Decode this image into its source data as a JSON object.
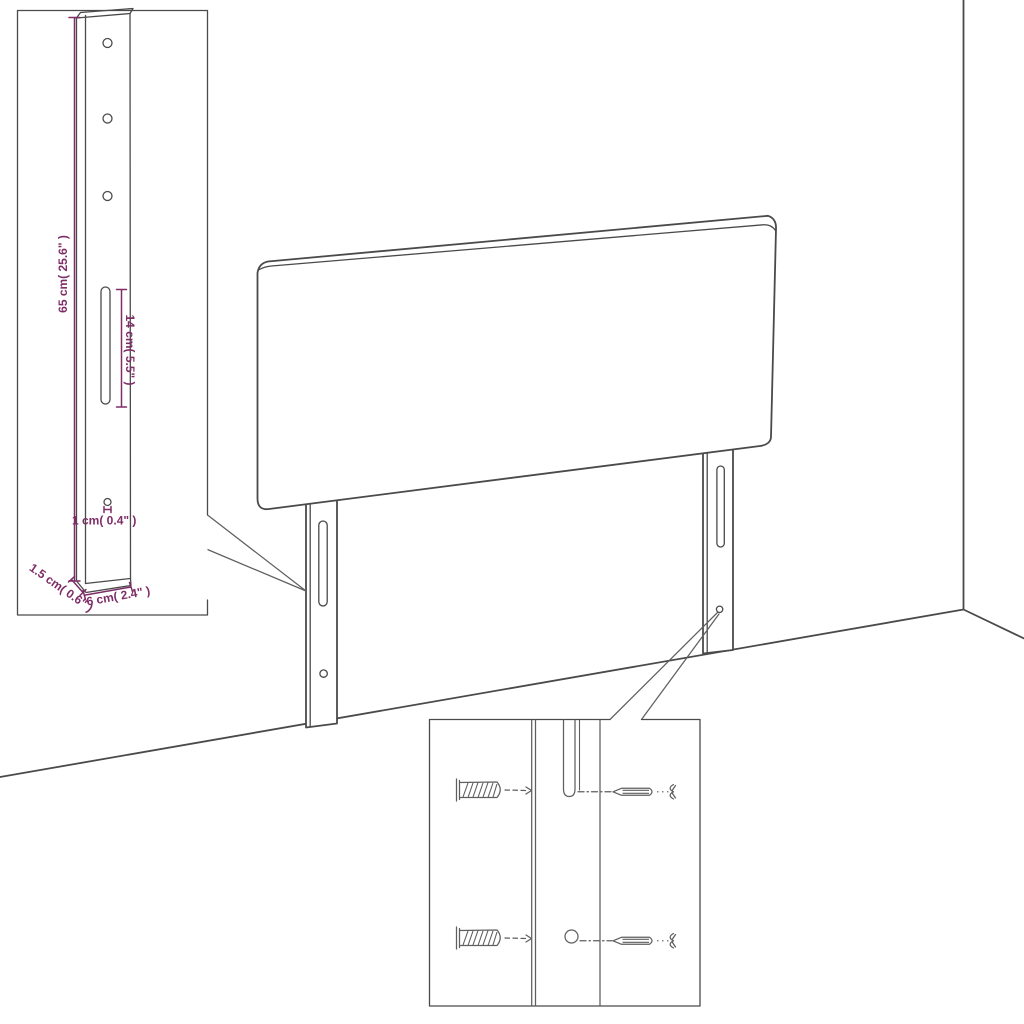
{
  "diagram": {
    "title": "headboard-assembly-dimension-diagram",
    "subject": "upholstered headboard with two mounting legs, wall corner, leg dimension inset and wall-plug/screw hardware inset"
  },
  "colors": {
    "line": "#4a4a4a",
    "line_soft": "#5f5f5f",
    "dimension": "#7e2d66",
    "background": "#ffffff"
  },
  "detail_inset_leg": {
    "dimensions": {
      "height": "65 cm( 25.6\" )",
      "slot_length": "14 cm( 5.5\" )",
      "hole_diameter": "1 cm( 0.4\" )",
      "thickness": "1.5 cm( 0.6\" )",
      "width": "6 cm( 2.4\" )"
    }
  },
  "detail_inset_hardware": {
    "items": [
      "wall-plug",
      "wall-plug",
      "screw",
      "screw"
    ]
  }
}
